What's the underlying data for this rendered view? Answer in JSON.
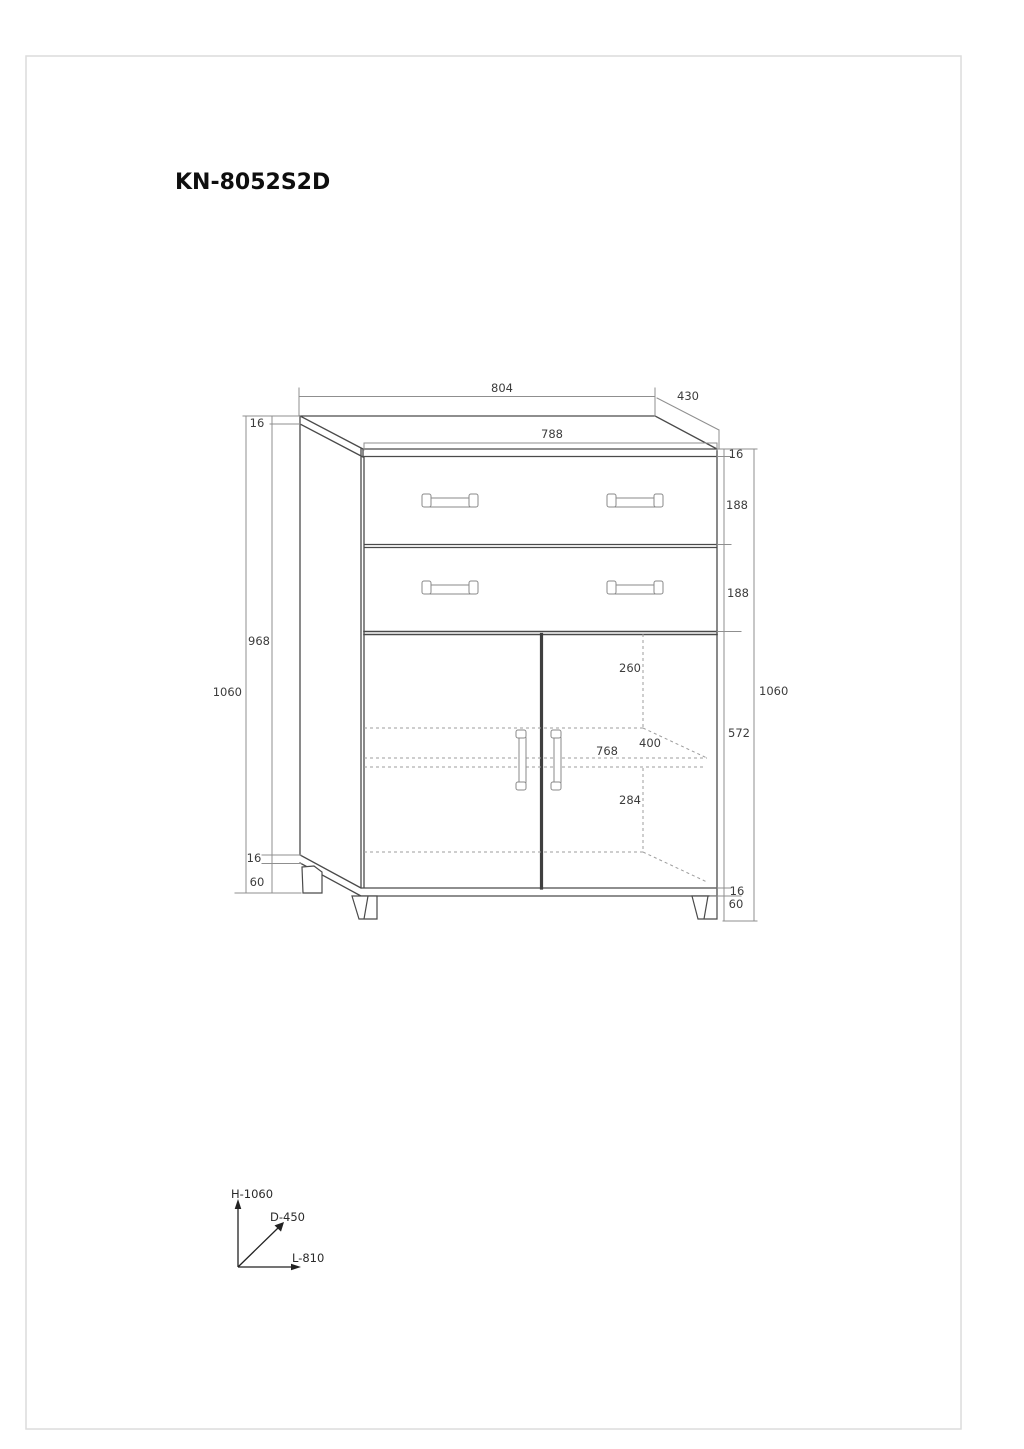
{
  "title": "KN-8052S2D",
  "dimensions": {
    "top_panel_width": "804",
    "top_panel_depth": "430",
    "carcass_width": "788",
    "top_panel_thickness_left": "16",
    "top_panel_thickness_right": "16",
    "drawer_front_height_1": "188",
    "drawer_front_height_2": "188",
    "side_panel_height": "968",
    "overall_height_left": "1060",
    "overall_height_right": "1060",
    "door_height": "572",
    "shelf_offset_top": "260",
    "interior_depth": "400",
    "shelf_width": "768",
    "shelf_offset_bottom": "284",
    "bottom_panel_thickness_left": "16",
    "leg_height_left": "60",
    "bottom_panel_thickness_right": "16",
    "leg_height_right": "60"
  },
  "legend": {
    "height_axis": "H-1060",
    "depth_axis": "D-450",
    "length_axis": "L-810"
  },
  "colors": {
    "outline": "#4a4a4a",
    "emphasis_line": "#3f3f3f",
    "hidden_line": "#9c9c9c",
    "dimension_line": "#8f8f8f",
    "dimension_text": "#3c3c3c",
    "handle_stroke": "#8a8a8a",
    "page_border": "#dcdcdc",
    "background": "#ffffff"
  }
}
